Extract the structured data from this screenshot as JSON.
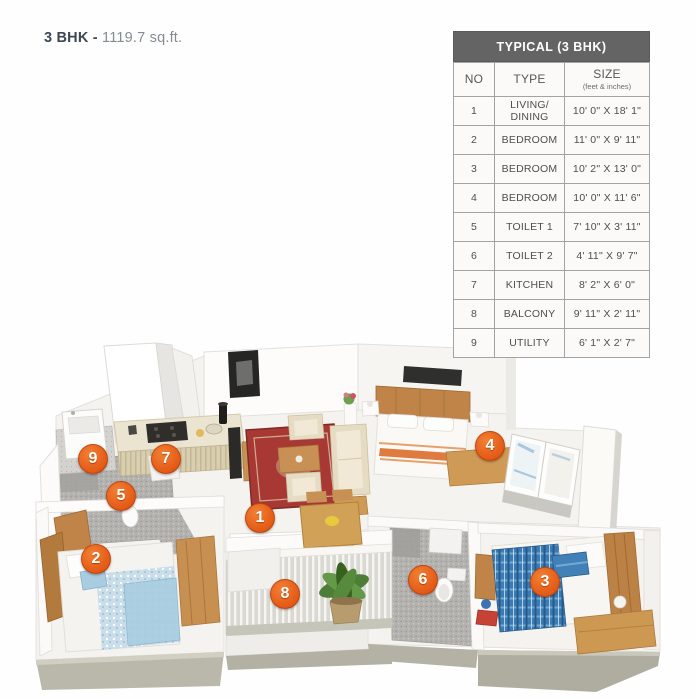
{
  "title": {
    "name": "3 BHK -",
    "area": "1119.7 sq.ft."
  },
  "spec_table": {
    "title": "TYPICAL (3 BHK)",
    "columns": {
      "no": "NO",
      "type": "TYPE",
      "size": "SIZE",
      "size_unit": "(feet & inches)"
    },
    "rows": [
      {
        "no": "1",
        "type": "LIVING/ DINING",
        "size": "10' 0\" X 18' 1\""
      },
      {
        "no": "2",
        "type": "BEDROOM",
        "size": "11' 0\" X 9' 11\""
      },
      {
        "no": "3",
        "type": "BEDROOM",
        "size": "10' 2\" X 13' 0\""
      },
      {
        "no": "4",
        "type": "BEDROOM",
        "size": "10' 0\" X 11' 6\""
      },
      {
        "no": "5",
        "type": "TOILET 1",
        "size": "7' 10\" X 3' 11\""
      },
      {
        "no": "6",
        "type": "TOILET 2",
        "size": "4' 11\" X 9' 7\""
      },
      {
        "no": "7",
        "type": "KITCHEN",
        "size": "8' 2\" X 6' 0\""
      },
      {
        "no": "8",
        "type": "BALCONY",
        "size": "9' 11\" X 2' 11\""
      },
      {
        "no": "9",
        "type": "UTILITY",
        "size": "6' 1\" X 2' 7\""
      }
    ]
  },
  "floorplan": {
    "markers": [
      {
        "number": "1",
        "room": "living-dining"
      },
      {
        "number": "2",
        "room": "bedroom-2"
      },
      {
        "number": "3",
        "room": "bedroom-3"
      },
      {
        "number": "4",
        "room": "bedroom-4"
      },
      {
        "number": "5",
        "room": "toilet-1"
      },
      {
        "number": "6",
        "room": "toilet-2"
      },
      {
        "number": "7",
        "room": "kitchen"
      },
      {
        "number": "8",
        "room": "balcony"
      },
      {
        "number": "9",
        "room": "utility"
      }
    ],
    "colors": {
      "marker_orange": "#e8611c",
      "table_header_gray": "#646464",
      "platform_side": "#aeada0",
      "wood": "#c89050",
      "bed_blue": "#3f7fb5",
      "carpet_red": "#a83833"
    }
  }
}
